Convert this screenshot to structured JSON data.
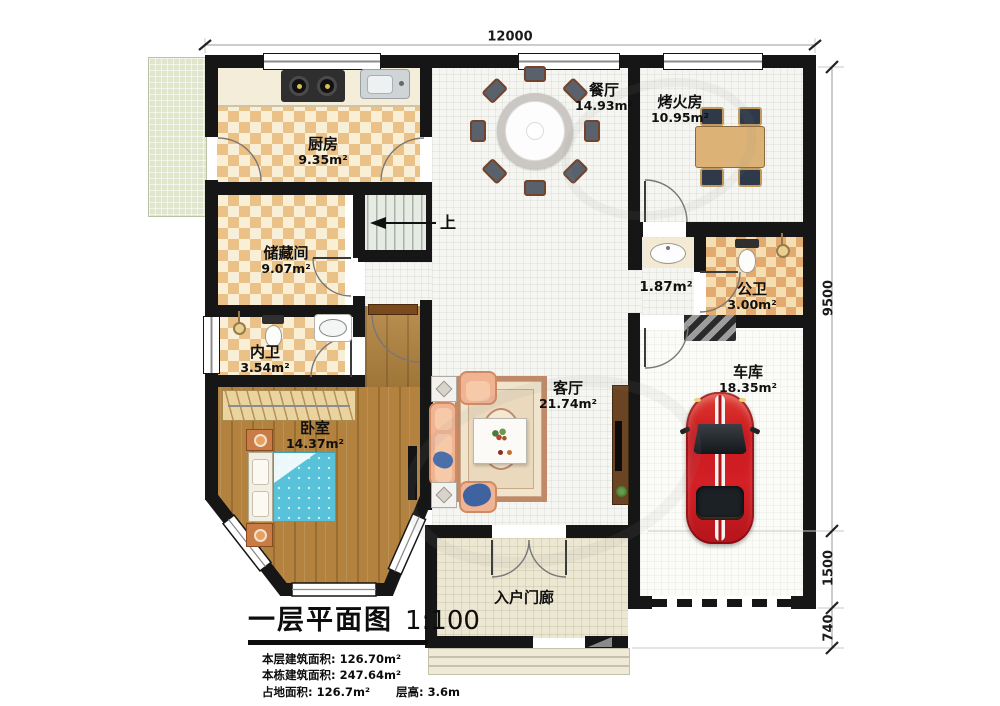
{
  "plan": {
    "title": "一层平面图",
    "scale": "1:100",
    "stairs_up": "上",
    "stats": [
      {
        "label": "本层建筑面积:",
        "value": "126.70m²"
      },
      {
        "label": "本栋建筑面积:",
        "value": "247.64m²"
      },
      {
        "label": "占地面积:",
        "value": "126.7m²"
      },
      {
        "label": "层高:",
        "value": "3.6m"
      }
    ]
  },
  "dimensions": {
    "top": "12000",
    "right_upper": "9500",
    "right_middle": "1500",
    "right_lower": "740"
  },
  "rooms": {
    "kitchen": {
      "name": "厨房",
      "area": "9.35m²"
    },
    "dining": {
      "name": "餐厅",
      "area": "14.93m²"
    },
    "firepit": {
      "name": "烤火房",
      "area": "10.95m²"
    },
    "storage": {
      "name": "储藏间",
      "area": "9.07m²"
    },
    "hallway": {
      "area": "1.87m²"
    },
    "public_bath": {
      "name": "公卫",
      "area": "3.00m²"
    },
    "inner_bath": {
      "name": "内卫",
      "area": "3.54m²"
    },
    "bedroom": {
      "name": "卧室",
      "area": "14.37m²"
    },
    "living": {
      "name": "客厅",
      "area": "21.74m²"
    },
    "garage": {
      "name": "车库",
      "area": "18.35m²"
    },
    "porch": {
      "name": "入户门廊"
    }
  },
  "colors": {
    "wall": "#161616",
    "floor_checker": "#eac186",
    "wood": "#b2823e",
    "bed_blue": "#58c2da",
    "car_red": "#c8191f"
  }
}
